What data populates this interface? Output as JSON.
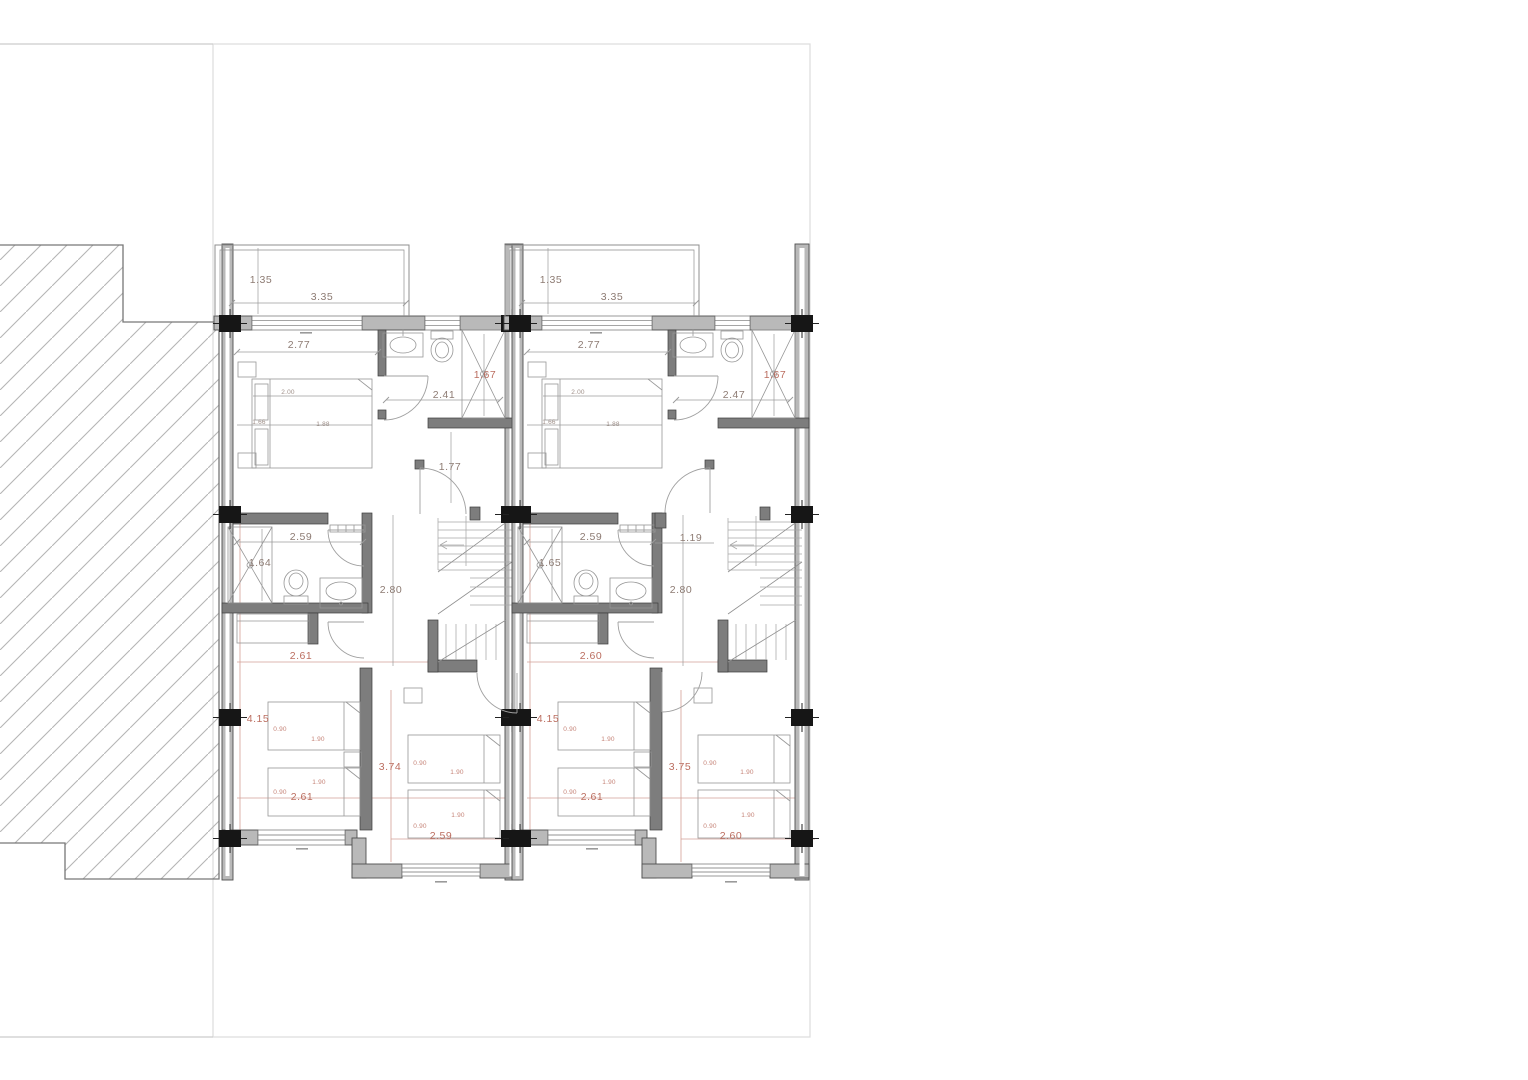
{
  "page": {
    "background": "#ffffff",
    "description": "Architectural floor plan - upper floor of two attached dwelling units with balconies, bathrooms, stairs and bedrooms"
  },
  "colors": {
    "dimension_text": "#8d7b73",
    "dimension_accent_text": "#bb6d5f",
    "accent_centerline": "#c47f72",
    "exterior_wall_fill": "#b9b9b9",
    "partition_wall_fill": "#7d7d7d",
    "column_fill": "#161616",
    "hatch_line": "#b5b5b5",
    "site_boundary_line": "#dcdcdc"
  },
  "plan": {
    "units": [
      {
        "name": "left-unit",
        "labels": [
          {
            "t": "1.35",
            "x": 261,
            "y": 283
          },
          {
            "t": "3.35",
            "x": 322,
            "y": 300
          },
          {
            "t": "2.77",
            "x": 299,
            "y": 348
          },
          {
            "t": "2.00",
            "x": 288,
            "y": 394,
            "s": "tiny"
          },
          {
            "t": "1.66",
            "x": 259,
            "y": 424,
            "s": "tiny"
          },
          {
            "t": "1.88",
            "x": 323,
            "y": 426,
            "s": "tiny"
          },
          {
            "t": "2.41",
            "x": 444,
            "y": 398
          },
          {
            "t": "1.67",
            "x": 485,
            "y": 378,
            "c": "r"
          },
          {
            "t": "1.77",
            "x": 450,
            "y": 470
          },
          {
            "t": "2.59",
            "x": 301,
            "y": 540
          },
          {
            "t": "1.64",
            "x": 260,
            "y": 566
          },
          {
            "t": "2.80",
            "x": 391,
            "y": 593
          },
          {
            "t": "2.61",
            "x": 301,
            "y": 659,
            "c": "r"
          },
          {
            "t": "4.15",
            "x": 258,
            "y": 722,
            "c": "r"
          },
          {
            "t": "2.61",
            "x": 302,
            "y": 800,
            "c": "r"
          },
          {
            "t": "3.74",
            "x": 390,
            "y": 770,
            "c": "r"
          },
          {
            "t": "2.59",
            "x": 441,
            "y": 839,
            "c": "r"
          },
          {
            "t": "0.90",
            "x": 280,
            "y": 731,
            "s": "tiny",
            "c": "r"
          },
          {
            "t": "1.90",
            "x": 318,
            "y": 741,
            "s": "tiny",
            "c": "r"
          },
          {
            "t": "1.90",
            "x": 319,
            "y": 784,
            "s": "tiny",
            "c": "r"
          },
          {
            "t": "0.90",
            "x": 280,
            "y": 794,
            "s": "tiny",
            "c": "r"
          },
          {
            "t": "0.90",
            "x": 420,
            "y": 765,
            "s": "tiny",
            "c": "r"
          },
          {
            "t": "1.90",
            "x": 457,
            "y": 774,
            "s": "tiny",
            "c": "r"
          },
          {
            "t": "1.90",
            "x": 458,
            "y": 817,
            "s": "tiny",
            "c": "r"
          },
          {
            "t": "0.90",
            "x": 420,
            "y": 828,
            "s": "tiny",
            "c": "r"
          }
        ]
      },
      {
        "name": "right-unit",
        "labels": [
          {
            "t": "1.35",
            "x": 551,
            "y": 283
          },
          {
            "t": "3.35",
            "x": 612,
            "y": 300
          },
          {
            "t": "2.77",
            "x": 589,
            "y": 348
          },
          {
            "t": "2.00",
            "x": 578,
            "y": 394,
            "s": "tiny"
          },
          {
            "t": "1.66",
            "x": 549,
            "y": 424,
            "s": "tiny"
          },
          {
            "t": "1.88",
            "x": 613,
            "y": 426,
            "s": "tiny"
          },
          {
            "t": "2.47",
            "x": 734,
            "y": 398
          },
          {
            "t": "1.67",
            "x": 775,
            "y": 378,
            "c": "r"
          },
          {
            "t": "2.59",
            "x": 591,
            "y": 540
          },
          {
            "t": "1.65",
            "x": 550,
            "y": 566
          },
          {
            "t": "1.19",
            "x": 691,
            "y": 541
          },
          {
            "t": "2.80",
            "x": 681,
            "y": 593
          },
          {
            "t": "2.60",
            "x": 591,
            "y": 659,
            "c": "r"
          },
          {
            "t": "4.15",
            "x": 548,
            "y": 722,
            "c": "r"
          },
          {
            "t": "2.61",
            "x": 592,
            "y": 800,
            "c": "r"
          },
          {
            "t": "3.75",
            "x": 680,
            "y": 770,
            "c": "r"
          },
          {
            "t": "2.60",
            "x": 731,
            "y": 839,
            "c": "r"
          },
          {
            "t": "0.90",
            "x": 570,
            "y": 731,
            "s": "tiny",
            "c": "r"
          },
          {
            "t": "1.90",
            "x": 608,
            "y": 741,
            "s": "tiny",
            "c": "r"
          },
          {
            "t": "1.90",
            "x": 609,
            "y": 784,
            "s": "tiny",
            "c": "r"
          },
          {
            "t": "0.90",
            "x": 570,
            "y": 794,
            "s": "tiny",
            "c": "r"
          },
          {
            "t": "0.90",
            "x": 710,
            "y": 765,
            "s": "tiny",
            "c": "r"
          },
          {
            "t": "1.90",
            "x": 747,
            "y": 774,
            "s": "tiny",
            "c": "r"
          },
          {
            "t": "1.90",
            "x": 748,
            "y": 817,
            "s": "tiny",
            "c": "r"
          },
          {
            "t": "0.90",
            "x": 710,
            "y": 828,
            "s": "tiny",
            "c": "r"
          }
        ]
      }
    ]
  }
}
